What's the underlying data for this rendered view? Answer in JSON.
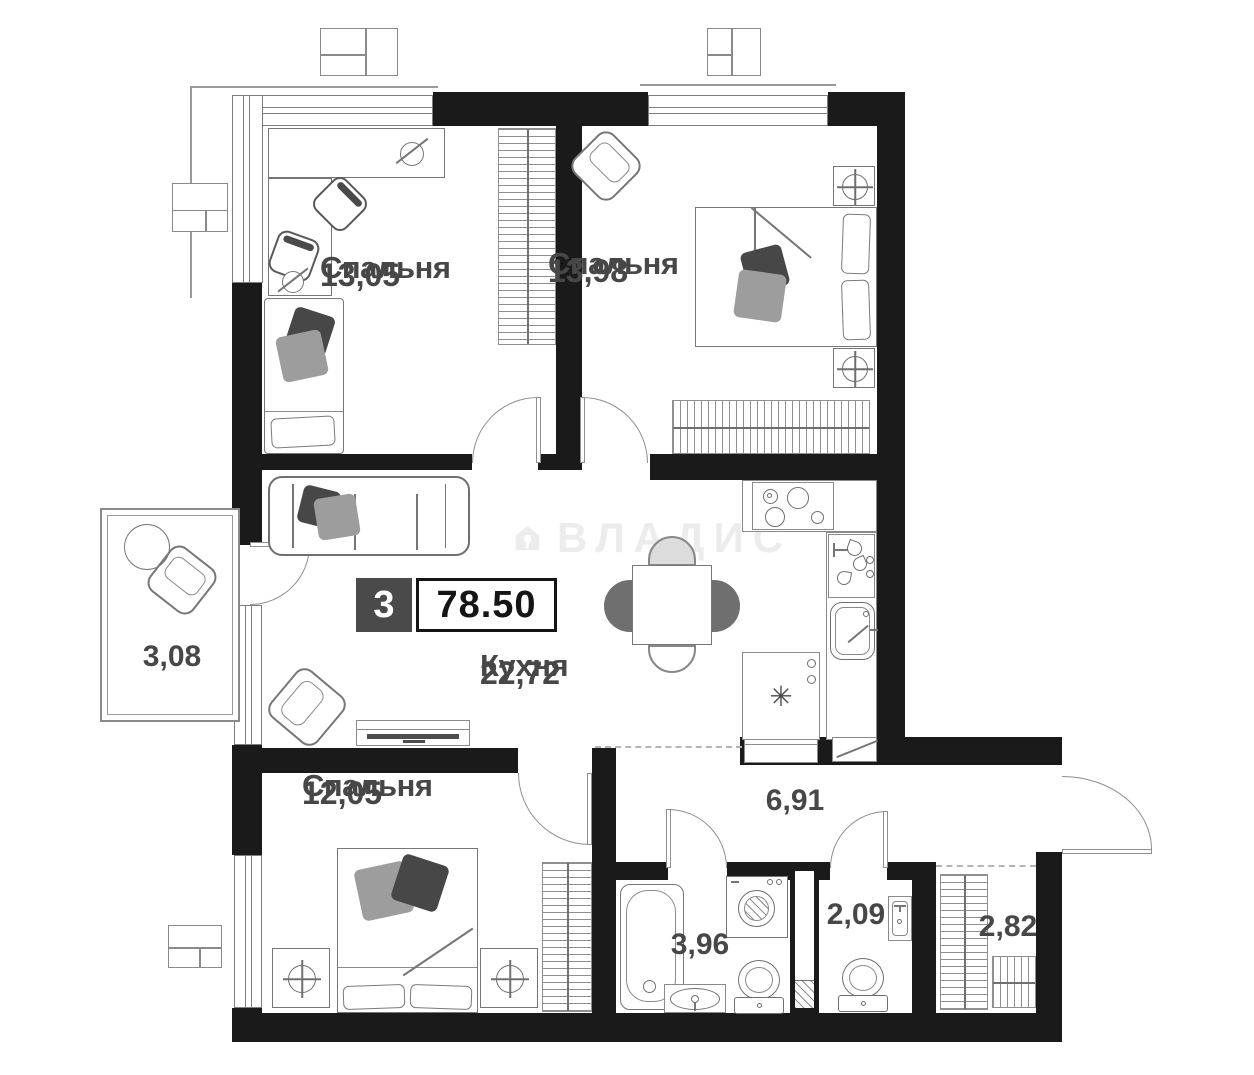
{
  "badge": {
    "rooms_count": "3",
    "total_area": "78.50"
  },
  "watermark": {
    "brand": "ВЛАДИС"
  },
  "rooms": {
    "bedroom_top_left": {
      "label": "Спальня",
      "area": "13,05"
    },
    "bedroom_top_right": {
      "label": "Спальня",
      "area": "13,98"
    },
    "kitchen": {
      "label": "Кухня",
      "area": "22,72"
    },
    "bedroom_bottom": {
      "label": "Спальня",
      "area": "12,05"
    },
    "balcony": {
      "area": "3,08"
    },
    "hallway": {
      "area": "6,91"
    },
    "bathroom": {
      "area": "3,96"
    },
    "wc": {
      "area": "2,09"
    },
    "storage": {
      "area": "2,82"
    }
  },
  "icons": {
    "fridge_snowflake": "✳",
    "brand_logo": "house-key-icon"
  },
  "colors": {
    "wall": "#1a1a1a",
    "outline": "#767676",
    "label_text": "#474747",
    "badge_dark_bg": "#4a4a4a",
    "badge_border": "#151515",
    "watermark": "#ececec"
  }
}
